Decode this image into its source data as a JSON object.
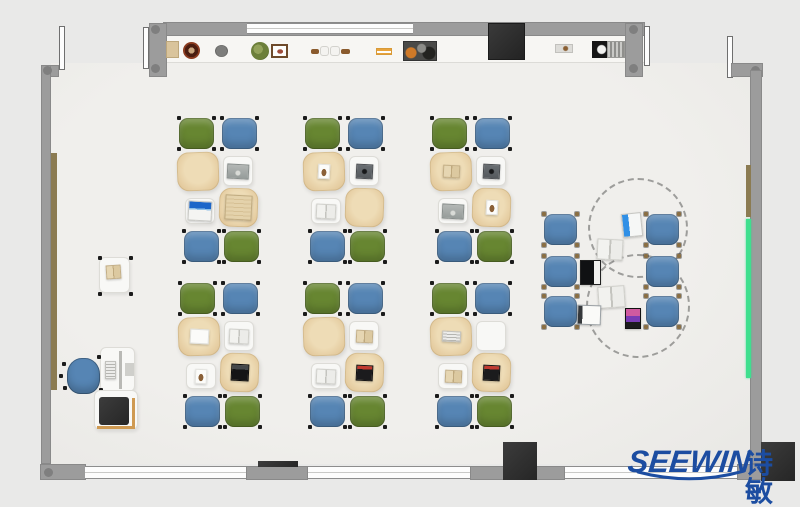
{
  "branding": {
    "logo_text": "SEEWIN",
    "logo_cjk": "诗敏",
    "logo_color": "#1c4da1"
  },
  "palette": {
    "wall": "#9c9c9c",
    "floor": "#edecea",
    "background": "#e9e9e8",
    "chair_green": "#678631",
    "chair_blue": "#5685b4",
    "desk_tan": "#e7cfa4",
    "desk_white": "#f8f8f6",
    "board_green": "#3fdf8e",
    "board_brown": "#8b7b52",
    "tv_black": "#2e2e2e"
  },
  "cluster_template": {
    "seat_size": [
      35,
      31
    ],
    "seats": [
      {
        "pos": "tl",
        "dx": 2,
        "dy": 0
      },
      {
        "pos": "tr",
        "dx": 45,
        "dy": 0
      },
      {
        "pos": "bl",
        "dx": 7,
        "dy": 113
      },
      {
        "pos": "br",
        "dx": 47,
        "dy": 113
      }
    ],
    "desks": [
      {
        "slot": "A",
        "dx": 0,
        "dy": 34,
        "w": 42,
        "h": 39,
        "kind": "tan"
      },
      {
        "slot": "B",
        "dx": 46,
        "dy": 38,
        "w": 30,
        "h": 30,
        "kind": "white"
      },
      {
        "slot": "C",
        "dx": 8,
        "dy": 80,
        "w": 30,
        "h": 26,
        "kind": "white"
      },
      {
        "slot": "D",
        "dx": 42,
        "dy": 70,
        "w": 39,
        "h": 39,
        "kind": "tan"
      }
    ]
  },
  "clusters": [
    {
      "name": "cluster-r1c1",
      "x": 177,
      "y": 118,
      "seat_colors": [
        "green",
        "blue",
        "blue",
        "green"
      ],
      "desk_items": {
        "A": "none",
        "B": "laptop-gray",
        "C": "laptop-blue",
        "D": "laptop-tan"
      }
    },
    {
      "name": "cluster-r1c2",
      "x": 303,
      "y": 118,
      "seat_colors": [
        "green",
        "blue",
        "blue",
        "green"
      ],
      "desk_items": {
        "A": "photo",
        "B": "tablet-dark",
        "C": "book-gray",
        "D": "none"
      }
    },
    {
      "name": "cluster-r1c3",
      "x": 430,
      "y": 118,
      "seat_colors": [
        "green",
        "blue",
        "blue",
        "green"
      ],
      "desk_items": {
        "A": "book-tan",
        "B": "tablet-dark",
        "C": "laptop-gray",
        "D": "photo"
      }
    },
    {
      "name": "cluster-r2c1",
      "x": 178,
      "y": 283,
      "seat_colors": [
        "green",
        "blue",
        "blue",
        "green"
      ],
      "desk_items": {
        "A": "paper",
        "B": "book-gray",
        "C": "photo",
        "D": "laptop-black"
      }
    },
    {
      "name": "cluster-r2c2",
      "x": 303,
      "y": 283,
      "seat_colors": [
        "green",
        "blue",
        "blue",
        "green"
      ],
      "desk_items": {
        "A": "none",
        "B": "book-tan",
        "C": "book-gray",
        "D": "laptop-red"
      }
    },
    {
      "name": "cluster-r2c3",
      "x": 430,
      "y": 283,
      "seat_colors": [
        "green",
        "blue",
        "blue",
        "green"
      ],
      "desk_items": {
        "A": "keyboard",
        "B": "none",
        "C": "book-tan",
        "D": "laptop-red"
      }
    }
  ],
  "round_group": {
    "tables_dashed": [
      {
        "cx": 638,
        "cy": 228,
        "r": 50
      },
      {
        "cx": 638,
        "cy": 306,
        "r": 52
      }
    ],
    "chairs": [
      {
        "x": 544,
        "y": 214
      },
      {
        "x": 544,
        "y": 256
      },
      {
        "x": 544,
        "y": 296
      },
      {
        "x": 646,
        "y": 214
      },
      {
        "x": 646,
        "y": 256
      },
      {
        "x": 646,
        "y": 296
      }
    ],
    "chair_size": [
      33,
      31
    ],
    "chair_color": "blue",
    "devices": [
      {
        "type": "tablet-blue",
        "x": 622,
        "y": 213,
        "w": 20,
        "h": 24,
        "rot": -6
      },
      {
        "type": "book-gray",
        "x": 597,
        "y": 239,
        "w": 26,
        "h": 21,
        "rot": 3
      },
      {
        "type": "laptop-black-w",
        "x": 580,
        "y": 260,
        "w": 21,
        "h": 25,
        "rot": 0
      },
      {
        "type": "book-gray",
        "x": 598,
        "y": 286,
        "w": 27,
        "h": 22,
        "rot": -4
      },
      {
        "type": "laptop-white",
        "x": 577,
        "y": 305,
        "w": 24,
        "h": 20,
        "rot": 2
      },
      {
        "type": "tablet-pink",
        "x": 625,
        "y": 308,
        "w": 16,
        "h": 21,
        "rot": 0
      }
    ]
  },
  "teacher_area": {
    "side_desk": {
      "x": 99,
      "y": 257,
      "w": 31,
      "h": 36
    },
    "side_desk_book": {
      "x": 106,
      "y": 265,
      "w": 15,
      "h": 14
    },
    "desk": {
      "x": 100,
      "y": 347,
      "w": 35,
      "h": 45
    },
    "monitor": {
      "x": 119,
      "y": 351,
      "w": 3,
      "h": 38
    },
    "keyboard": {
      "x": 105,
      "y": 361,
      "w": 11,
      "h": 18
    },
    "pad": {
      "x": 125,
      "y": 363,
      "w": 9,
      "h": 13
    },
    "chair": {
      "x": 67,
      "y": 358,
      "w": 33,
      "h": 36
    },
    "printer_table": {
      "x": 94,
      "y": 390,
      "w": 44,
      "h": 40
    },
    "printer": {
      "x": 99,
      "y": 397,
      "w": 30,
      "h": 28
    },
    "table_trim_v": {
      "x": 132,
      "y": 398,
      "w": 3,
      "h": 31
    },
    "table_trim_h": {
      "x": 97,
      "y": 426,
      "w": 38,
      "h": 3
    }
  },
  "shelf_items": [
    {
      "type": "box-tan",
      "x": 166,
      "y": 41,
      "w": 13,
      "h": 17
    },
    {
      "type": "pot-brown",
      "x": 183,
      "y": 42,
      "w": 17,
      "h": 17
    },
    {
      "type": "pot-gray",
      "x": 215,
      "y": 45,
      "w": 13,
      "h": 12
    },
    {
      "type": "plant-green",
      "x": 251,
      "y": 42,
      "w": 18,
      "h": 18
    },
    {
      "type": "frame",
      "x": 271,
      "y": 44,
      "w": 17,
      "h": 14
    },
    {
      "type": "stick-brown",
      "x": 311,
      "y": 49,
      "w": 8,
      "h": 5
    },
    {
      "type": "bowl-white",
      "x": 320,
      "y": 46,
      "w": 9,
      "h": 10
    },
    {
      "type": "bowl-white",
      "x": 330,
      "y": 46,
      "w": 10,
      "h": 10
    },
    {
      "type": "stick-brown",
      "x": 341,
      "y": 49,
      "w": 9,
      "h": 5
    },
    {
      "type": "sticks-orange",
      "x": 376,
      "y": 48,
      "w": 16,
      "h": 7
    },
    {
      "type": "tray-dark",
      "x": 403,
      "y": 41,
      "w": 34,
      "h": 20
    },
    {
      "type": "box-small",
      "x": 555,
      "y": 44,
      "w": 18,
      "h": 9
    },
    {
      "type": "cabinet-black",
      "x": 592,
      "y": 41,
      "w": 16,
      "h": 17
    },
    {
      "type": "vent-gray",
      "x": 607,
      "y": 41,
      "w": 18,
      "h": 17
    }
  ]
}
